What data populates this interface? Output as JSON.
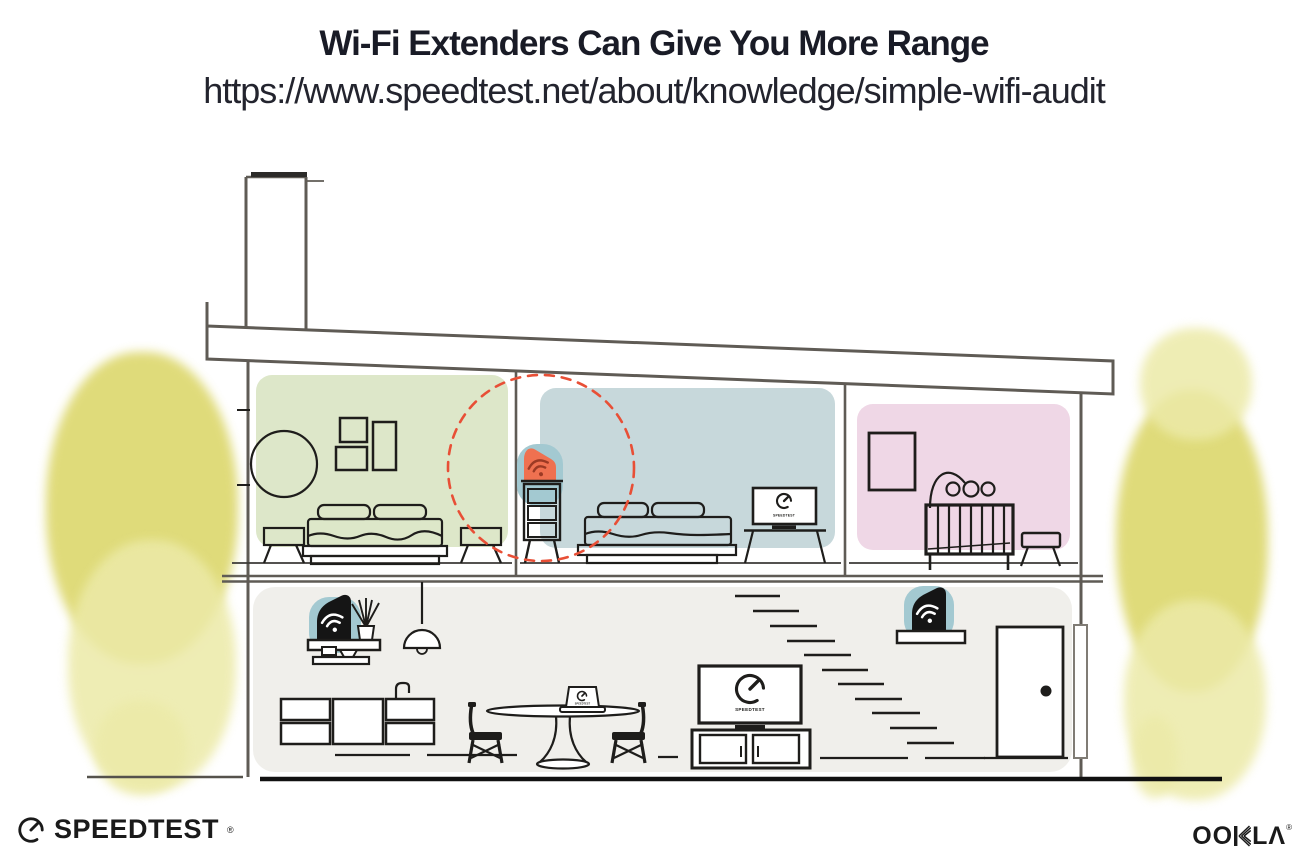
{
  "header": {
    "title": "Wi-Fi Extenders Can Give You More Range",
    "url": "https://www.speedtest.net/about/knowledge/simple-wifi-audit"
  },
  "illustration": {
    "bedroom_tv_label": "SPEEDTEST",
    "living_tv_label": "SPEEDTEST",
    "laptop_label": "SPEEDTEST"
  },
  "footer": {
    "speedtest_wordmark": "SPEEDTEST",
    "speedtest_reg": "®",
    "ookla_left": "OO",
    "ookla_right": "LΛ",
    "ookla_reg": "®"
  },
  "colors": {
    "title-ink": "#191b26",
    "url-ink": "#23242e",
    "line": "#5f5b55",
    "ink": "#1e1d1b",
    "ink2": "#1a1a1a",
    "room-green": "#dde7c9",
    "room-blue": "#c7d8db",
    "room-pink": "#efd7e6",
    "floor-gray": "#f0efeb",
    "device-blue": "#a3c9d1",
    "device-orange": "#ef7150",
    "wifi-on-orange": "#9c3a24",
    "dashed-red": "#e84f36",
    "tree-yellow": "#d7d155",
    "tree-yellow-light": "#eceaa8"
  }
}
